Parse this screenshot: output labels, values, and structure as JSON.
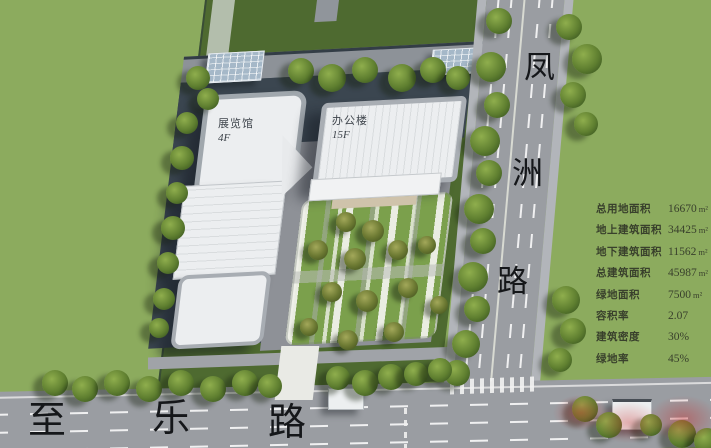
{
  "roads": {
    "fengzhou": {
      "name": "凤洲路",
      "chars": [
        "凤",
        "洲",
        "路"
      ]
    },
    "zhile": {
      "name": "至乐路",
      "chars": [
        "至",
        "乐",
        "路"
      ]
    }
  },
  "buildings": {
    "exhibition_hall": {
      "name": "展览馆",
      "floors": "4F"
    },
    "office_tower": {
      "name": "办公楼",
      "floors": "15F"
    }
  },
  "stats": {
    "rows": [
      {
        "label": "总用地面积",
        "value": "16670",
        "unit": "m²"
      },
      {
        "label": "地上建筑面积",
        "value": "34425",
        "unit": "m²"
      },
      {
        "label": "地下建筑面积",
        "value": "11562",
        "unit": "m²"
      },
      {
        "label": "总建筑面积",
        "value": "45987",
        "unit": "m²"
      },
      {
        "label": "绿地面积",
        "value": "7500",
        "unit": "m²"
      },
      {
        "label": "容积率",
        "value": "2.07",
        "unit": ""
      },
      {
        "label": "建筑密度",
        "value": "30%",
        "unit": ""
      },
      {
        "label": "绿地率",
        "value": "45%",
        "unit": ""
      }
    ]
  },
  "colors": {
    "lawn": "#8cab5e",
    "site_green": "#4e6a30",
    "road_gray": "#9a9da2",
    "building_white": "#eceef0",
    "plaza_navy": "#3b4650",
    "garden_green": "#7ba04c",
    "stats_text": "#39402c",
    "watermark_red": "#c83232"
  }
}
